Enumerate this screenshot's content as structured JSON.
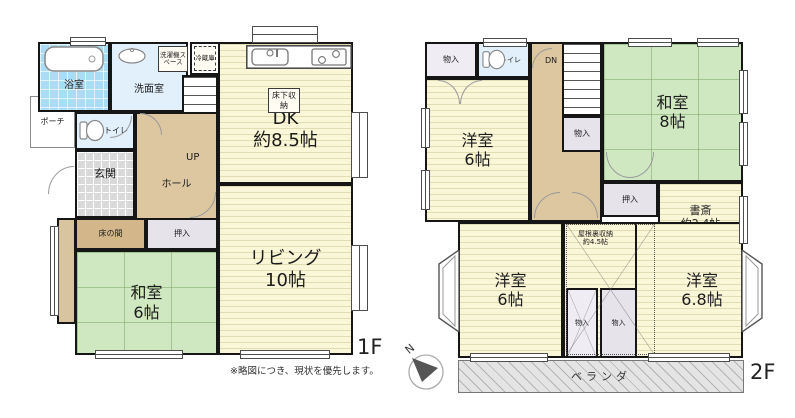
{
  "note": "※略図につき、現状を優先します。",
  "floor1": {
    "label": "1F",
    "bath": "浴室",
    "washroom": "洗面室",
    "laundry": "洗濯機スペース",
    "fridge": "冷蔵庫",
    "dk_name": "DK",
    "dk_size": "約8.5帖",
    "underfloor": "床下収納",
    "up": "UP",
    "hall": "ホール",
    "toilet": "トイレ",
    "porch": "ポーチ",
    "entrance": "玄関",
    "tokonoma": "床の間",
    "closet": "押入",
    "washitsu_name": "和室",
    "washitsu_size": "6帖",
    "living_name": "リビング",
    "living_size": "10帖"
  },
  "floor2": {
    "label": "2F",
    "storage_tl": "物入",
    "toilet": "トイレ",
    "dn": "DN",
    "storage_mid": "物入",
    "yoshitsu_tl_name": "洋室",
    "yoshitsu_tl_size": "6帖",
    "washitsu_name": "和室",
    "washitsu_size": "8帖",
    "closet": "押入",
    "study_name": "書斎",
    "study_size": "約2.4帖",
    "attic_name": "屋根裏収納",
    "attic_size": "約4.5帖",
    "yoshitsu_bl_name": "洋室",
    "yoshitsu_bl_size": "6帖",
    "yoshitsu_br_name": "洋室",
    "yoshitsu_br_size": "6.8帖",
    "storage_b1": "物入",
    "storage_b2": "物入",
    "veranda": "ベランダ",
    "compass": "N"
  },
  "colors": {
    "wall": "#161616",
    "wood_floor": "#faf7d8",
    "tatami": "#cfe8c1",
    "hall": "#dcc7a0",
    "tokonoma": "#d3b78a",
    "bath": "#abdcf5",
    "water_room": "#e2f0fb",
    "closet": "#e6e3eb",
    "entrance": "#d9d9d9",
    "veranda": "#e4e4e4"
  }
}
